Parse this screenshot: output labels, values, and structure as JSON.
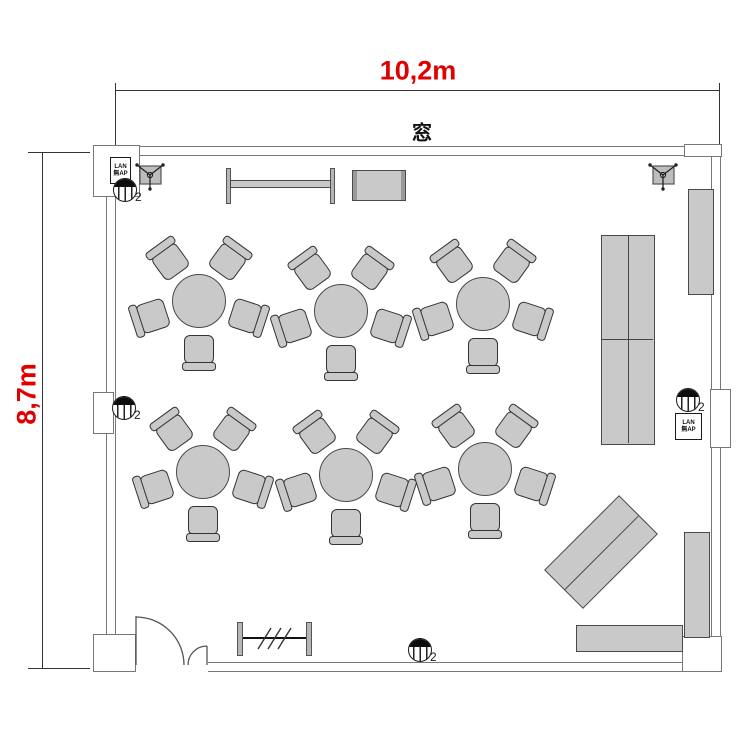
{
  "annotations": {
    "width_label": "10,2m",
    "height_label": "8,7m",
    "window_label": "窓",
    "accent_color": "#e00000"
  },
  "symbols": {
    "outlet_count_label": "2",
    "lan_box": {
      "line1": "LAN",
      "line2": "無AP"
    },
    "outlets": [
      {
        "x": 125,
        "y": 190
      },
      {
        "x": 124,
        "y": 408
      },
      {
        "x": 688,
        "y": 400
      },
      {
        "x": 420,
        "y": 650
      }
    ],
    "speakers": [
      {
        "x": 150,
        "y": 175
      },
      {
        "x": 663,
        "y": 175
      }
    ]
  },
  "floorplan": {
    "room": {
      "width_m": "10,2",
      "height_m": "8,7"
    },
    "tables": [
      {
        "x": 199,
        "y": 301
      },
      {
        "x": 341,
        "y": 311
      },
      {
        "x": 483,
        "y": 304
      },
      {
        "x": 203,
        "y": 472
      },
      {
        "x": 346,
        "y": 475
      },
      {
        "x": 485,
        "y": 469
      }
    ],
    "chairs_per_table": 5,
    "chair_angles_deg": [
      18,
      90,
      162,
      234,
      306
    ],
    "chair_radius_px": 54,
    "furniture_colors": {
      "fill": "#c9c9c9",
      "outline": "#4a4a4a",
      "wall": "#777"
    }
  }
}
